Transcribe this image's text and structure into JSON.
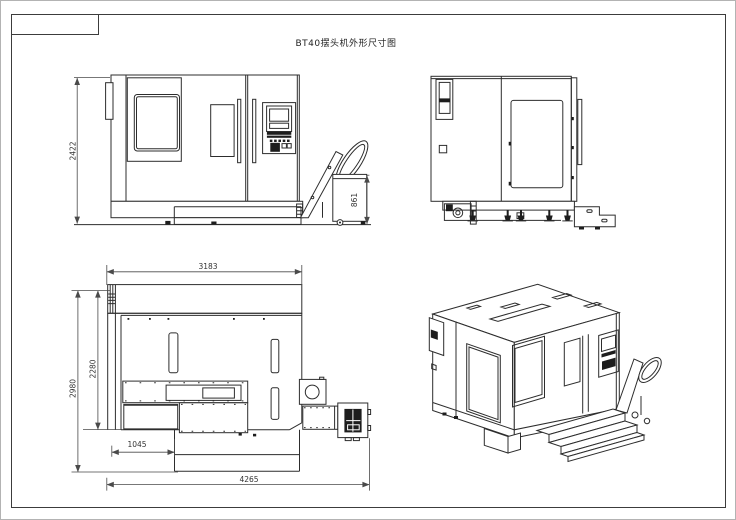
{
  "title": "BT40摆头机外形尺寸图",
  "dimensions": {
    "front_overall_height": "2422",
    "chip_conveyor_height": "861",
    "plan_body_width": "3183",
    "plan_total_depth": "2980",
    "plan_body_depth": "2280",
    "plan_left_offset": "1045",
    "plan_total_length": "4265"
  },
  "colors": {
    "line": "#2d2d2d",
    "dimension_line": "#4a4a4a",
    "frame": "#3c3c3c",
    "page_background": "#ffffff",
    "window_border": "#b3b3b3"
  }
}
